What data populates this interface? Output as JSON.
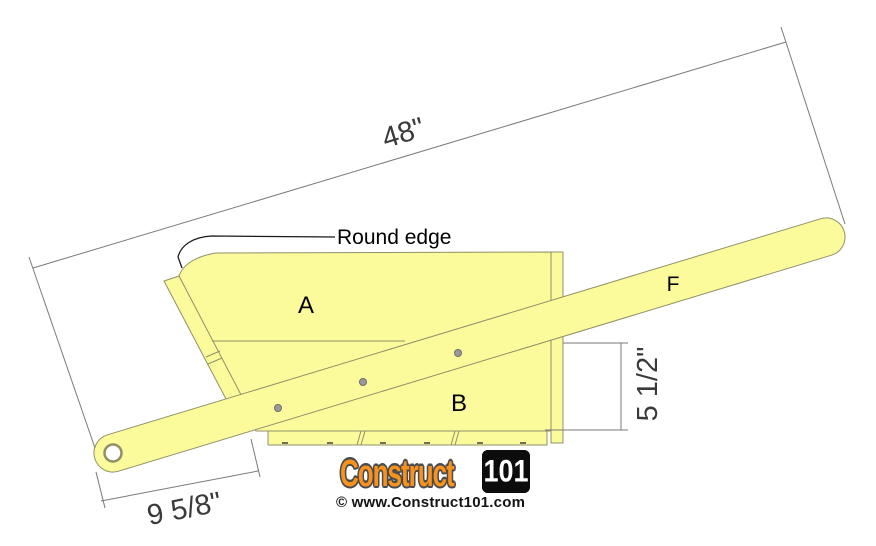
{
  "diagram": {
    "part_labels": {
      "panel_a": "A",
      "panel_b": "B",
      "handle_f": "F"
    },
    "annotations": {
      "round_edge": "Round edge"
    },
    "dimensions": {
      "overall_length": "48\"",
      "handle_end_offset": "9 5/8\"",
      "side_board_height": "5 1/2\""
    },
    "colors": {
      "wood_fill": "#FBFB9B",
      "wood_outline": "#90906B",
      "dimension_line": "#7A7A7A",
      "dimension_text": "#3A3A3A",
      "label_text": "#000000"
    }
  },
  "branding": {
    "logo_text": "Construct",
    "logo_badge": "101",
    "website": "© www.Construct101.com",
    "logo_orange": "#F6921E",
    "logo_outline": "#4A4A4C",
    "badge_bg": "#0C0C0C",
    "badge_text": "#FFFFFF"
  }
}
